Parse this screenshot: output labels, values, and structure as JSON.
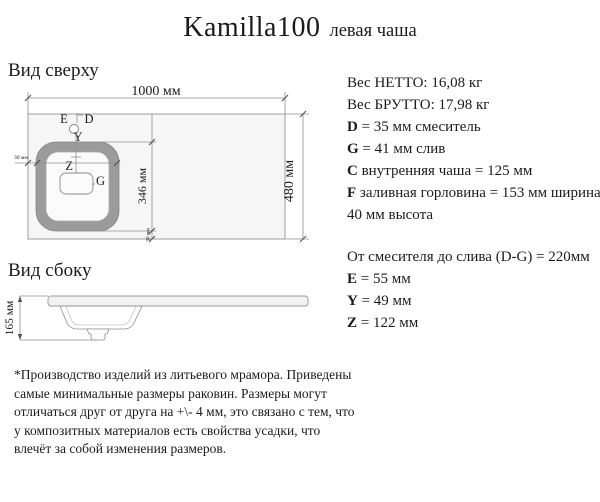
{
  "title": {
    "model": "Kamilla100",
    "variant": "левая чаша"
  },
  "top_view": {
    "heading": "Вид сверху",
    "labels": {
      "e": "E",
      "d": "D",
      "y": "Y",
      "z": "Z",
      "g": "G"
    },
    "dims": {
      "width": "1000 мм",
      "depth": "480 мм",
      "bowl_length": "346 мм",
      "edge_left": "30 мм",
      "edge_bottom": "30 мм"
    }
  },
  "side_view": {
    "heading": "Вид сбоку",
    "dims": {
      "height": "165 мм"
    }
  },
  "specs": {
    "lines": [
      {
        "prefix": "",
        "text": "Вес НЕТТО: 16,08 кг"
      },
      {
        "prefix": "",
        "text": "Вес БРУТТО: 17,98 кг"
      },
      {
        "prefix": "D",
        "text": " = 35 мм смеситель"
      },
      {
        "prefix": "G",
        "text": " = 41 мм слив"
      },
      {
        "prefix": "C",
        "text": " внутренняя чаша = 125 мм"
      },
      {
        "prefix": "F",
        "text": " заливная горловина = 153 мм ширина,"
      },
      {
        "prefix": "",
        "text": "40 мм высота"
      },
      {
        "prefix": "",
        "text": "От смесителя до слива (D-G) = 220мм"
      },
      {
        "prefix": "E",
        "text": " = 55 мм"
      },
      {
        "prefix": "Y",
        "text": " = 49 мм"
      },
      {
        "prefix": "Z",
        "text": " = 122 мм"
      }
    ]
  },
  "footnote": {
    "lines": [
      "*Производство изделий из литьевого мрамора. Приведены",
      "самые минимальные размеры раковин. Размеры могут",
      "отличаться друг от друга на +\\- 4 мм, это связано с тем, что",
      "у композитных материалов есть свойства усадки, что",
      "влечёт за собой изменения размеров."
    ]
  }
}
